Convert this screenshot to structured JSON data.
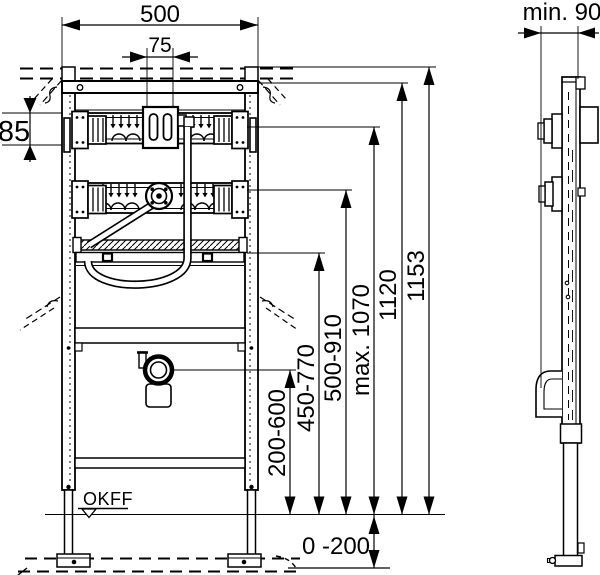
{
  "drawing": {
    "colors": {
      "line": "#000000",
      "background": "#ffffff"
    },
    "labels": {
      "overall_width": "500",
      "flush_pipe_width": "75",
      "rail_height": "85",
      "min_depth": "min. 90",
      "total_height": "1153",
      "frame_height": "1120",
      "flush_unit_max_height": "max. 1070",
      "water_connection_range": "500-910",
      "mounting_plate_range": "450-770",
      "drain_height_range": "200-600",
      "floor_buildup_range": "0 -200",
      "floor_level_datum": "OKFF"
    }
  }
}
